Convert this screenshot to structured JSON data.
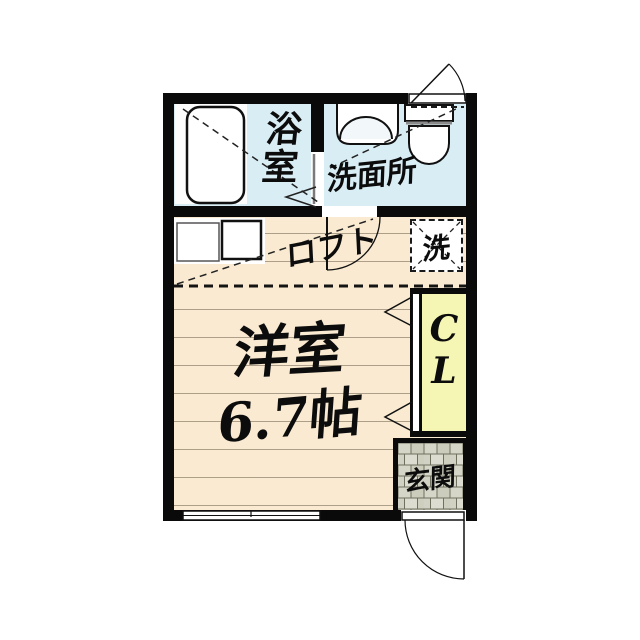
{
  "plan_type": "apartment-floorplan",
  "rooms": {
    "bathroom": {
      "label": "浴室"
    },
    "washroom": {
      "label": "洗面所"
    },
    "loft": {
      "label": "ロフト"
    },
    "laundry": {
      "label": "洗"
    },
    "main": {
      "label": "洋室",
      "size": "6.7帖"
    },
    "closet": {
      "line1": "C",
      "line2": "L"
    },
    "entrance": {
      "label": "玄関"
    }
  },
  "colors": {
    "wall": "#0a0a0a",
    "wet_area_floor": "#d9edf4",
    "wood_floor": "#f9ead1",
    "closet_fill": "#f6f6b4",
    "entrance_tile": "#dadacd",
    "background": "#ffffff"
  },
  "fixtures": [
    "bathtub",
    "wash-basin",
    "toilet",
    "kitchen-units",
    "washer-space",
    "window",
    "entry-door",
    "interior-doors",
    "closet-doors"
  ]
}
